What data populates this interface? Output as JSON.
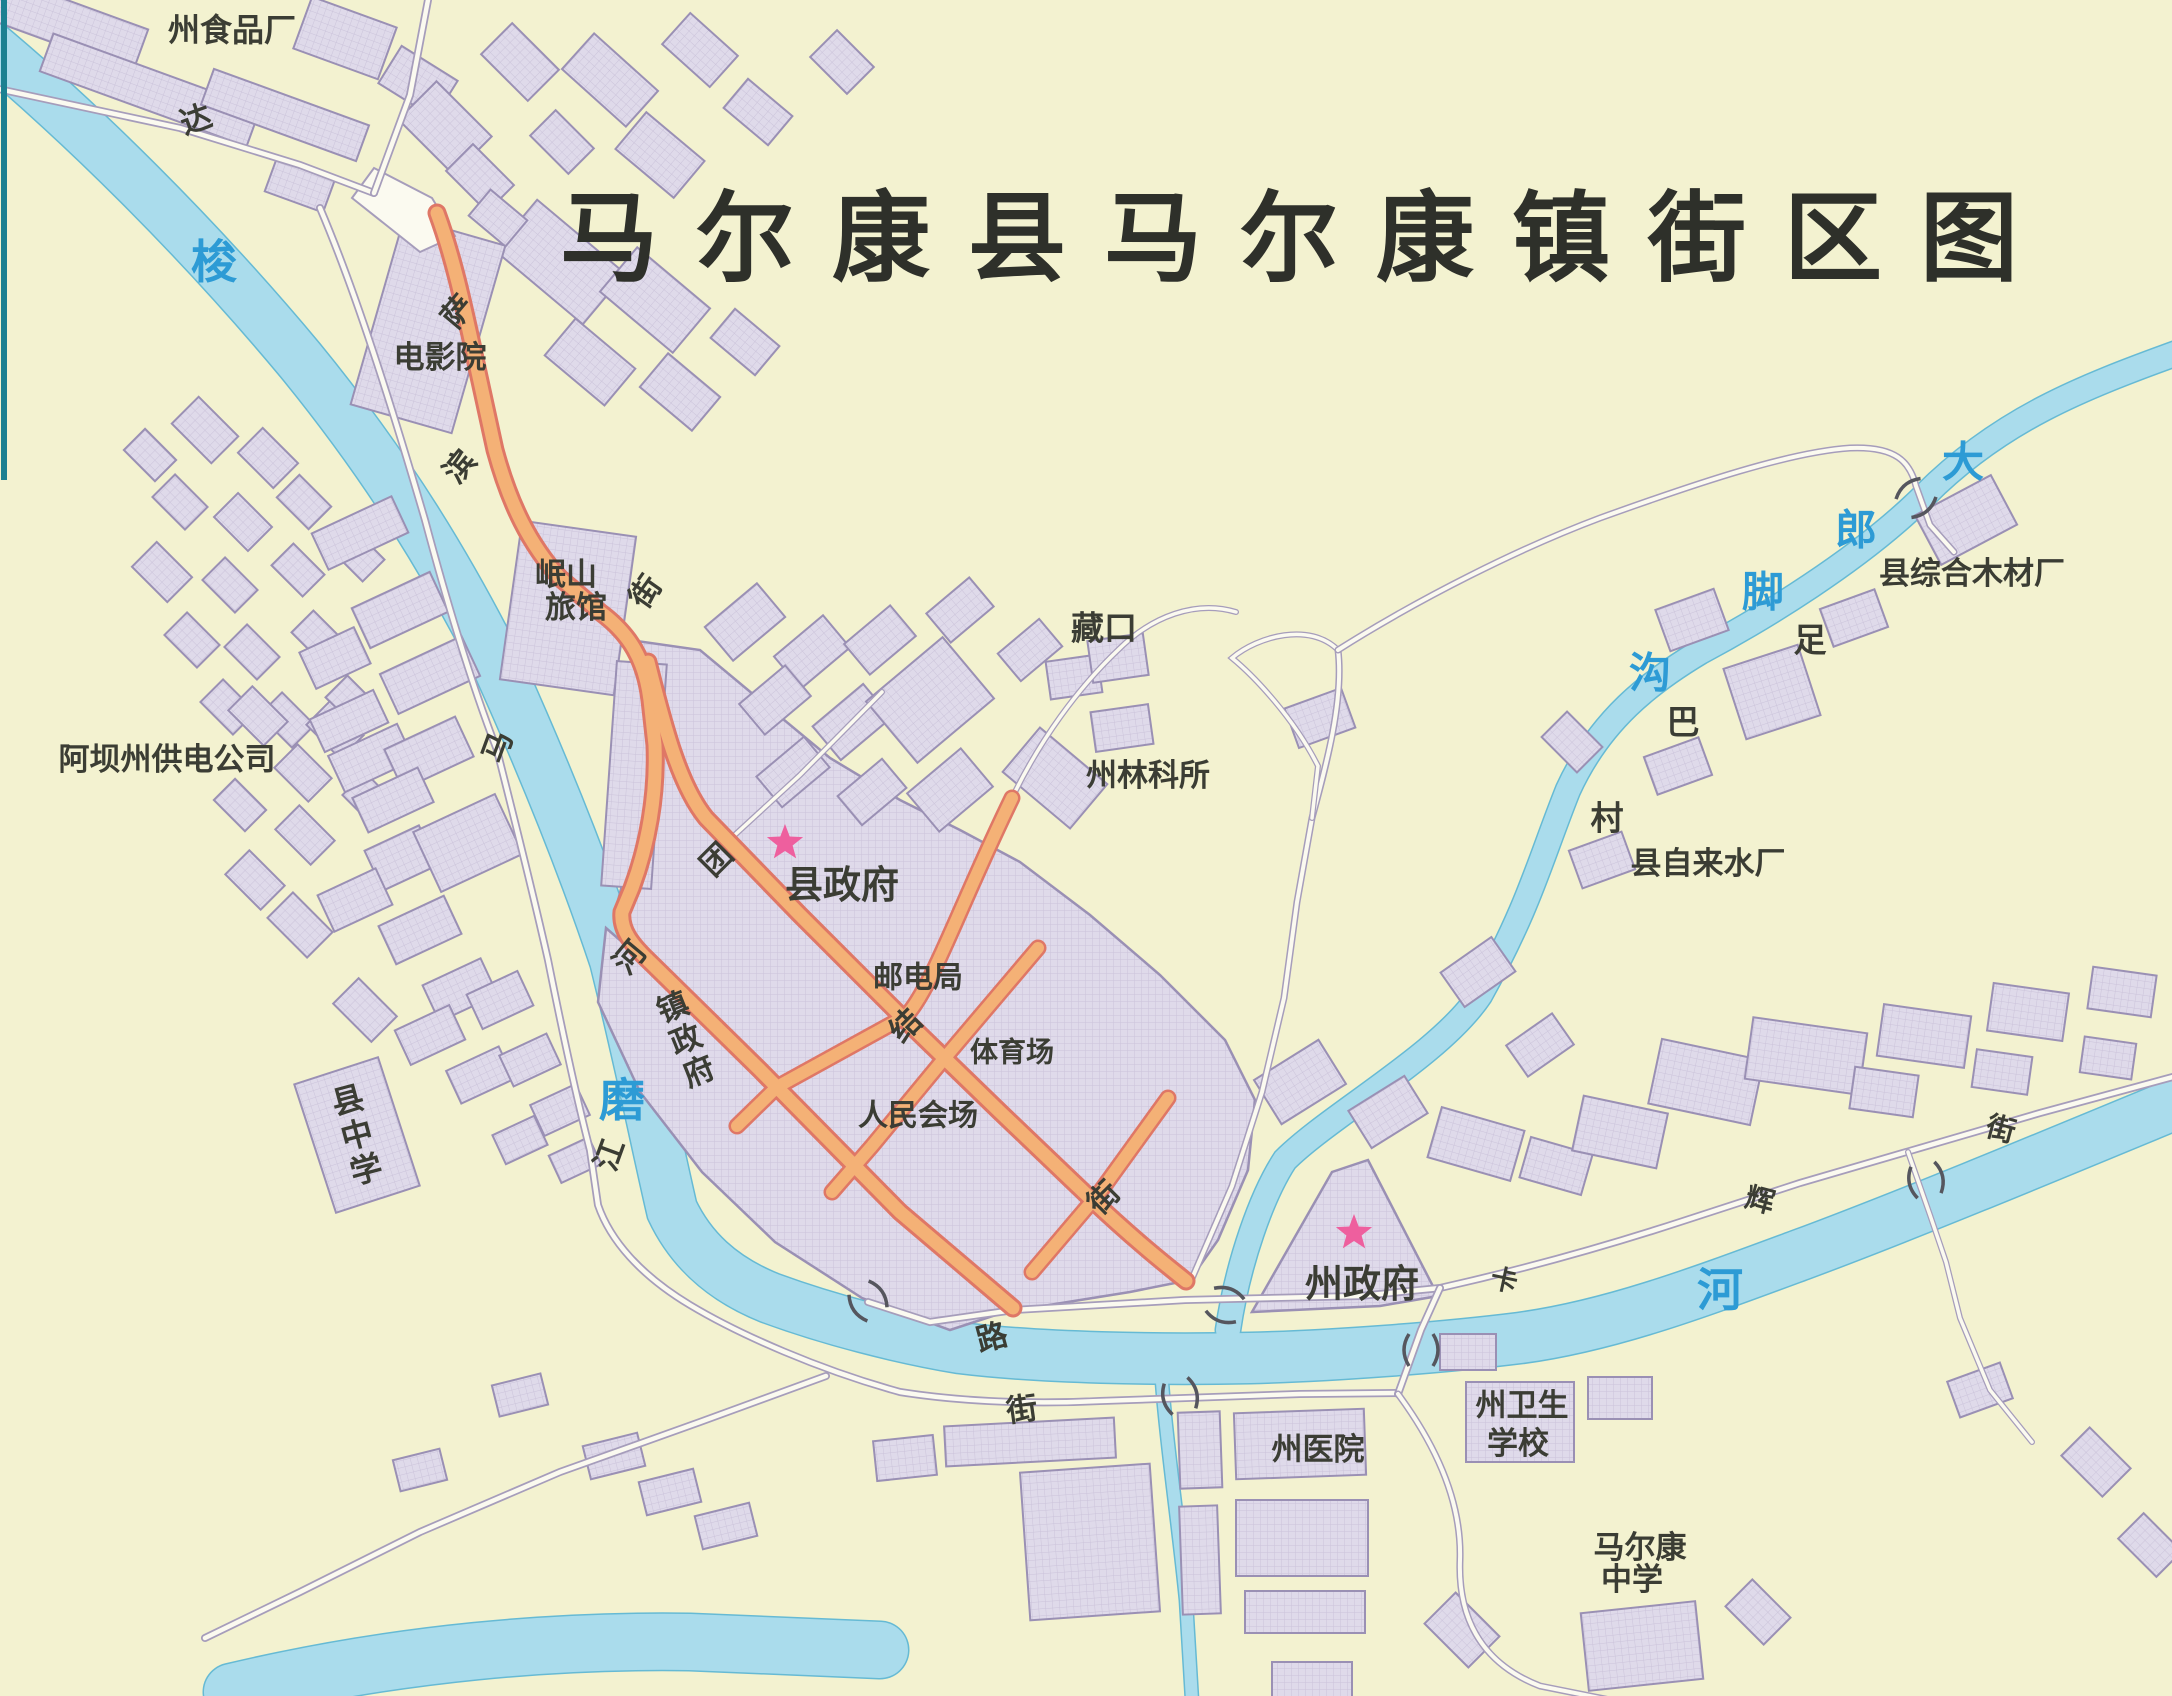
{
  "title": "马尔康县马尔康镇街区图",
  "map": {
    "colors": {
      "paper": "#f3f2d0",
      "water": "#aadcec",
      "water_edge": "#66bad4",
      "building": "#dfdaea",
      "building_edge": "#9a90b4",
      "road_orange": "#f4b176",
      "road_orange_edge": "#df7766",
      "road_white": "#fbfaf0",
      "road_edge": "#a69dbb",
      "label": "#3b3d34",
      "river_label": "#2d9bd5",
      "star": "#ee5f9e",
      "neatline": "#1b8091"
    },
    "stars": [
      {
        "name": "county-government-star",
        "x": 785,
        "y": 843
      },
      {
        "name": "prefecture-government-star",
        "x": 1354,
        "y": 1233
      }
    ],
    "bridges": [
      {
        "x": 1225,
        "y": 1305,
        "r": 20
      },
      {
        "x": 1421,
        "y": 1350,
        "r": 90
      },
      {
        "x": 1180,
        "y": 1396,
        "r": 75
      },
      {
        "x": 868,
        "y": 1301,
        "r": 55
      },
      {
        "x": 1926,
        "y": 1180,
        "r": 78
      },
      {
        "x": 1916,
        "y": 498,
        "r": -40
      }
    ],
    "labels": [
      {
        "t": "州食品厂",
        "x": 232,
        "y": 30,
        "s": 32,
        "c": "place"
      },
      {
        "t": "电影院",
        "x": 440,
        "y": 358,
        "s": 31,
        "c": "place"
      },
      {
        "t": "岷山",
        "x": 566,
        "y": 575,
        "s": 31,
        "c": "place"
      },
      {
        "t": "旅馆",
        "x": 576,
        "y": 608,
        "s": 31,
        "c": "place"
      },
      {
        "t": "阿坝州供电公司",
        "x": 167,
        "y": 760,
        "s": 31,
        "c": "place"
      },
      {
        "t": "县中学",
        "x": 357,
        "y": 1135,
        "s": 32,
        "c": "place",
        "v": 1,
        "r": -15
      },
      {
        "t": "县政府",
        "x": 842,
        "y": 885,
        "s": 38,
        "c": "place"
      },
      {
        "t": "邮电局",
        "x": 918,
        "y": 978,
        "s": 30,
        "c": "place"
      },
      {
        "t": "体育场",
        "x": 1012,
        "y": 1052,
        "s": 28,
        "c": "place"
      },
      {
        "t": "人民会场",
        "x": 918,
        "y": 1116,
        "s": 30,
        "c": "place"
      },
      {
        "t": "镇政府",
        "x": 686,
        "y": 1040,
        "s": 31,
        "c": "place",
        "v": 1,
        "r": -22
      },
      {
        "t": "藏口",
        "x": 1104,
        "y": 628,
        "s": 33,
        "c": "place"
      },
      {
        "t": "州林科所",
        "x": 1148,
        "y": 776,
        "s": 31,
        "c": "place"
      },
      {
        "t": "州政府",
        "x": 1362,
        "y": 1284,
        "s": 38,
        "c": "place"
      },
      {
        "t": "州医院",
        "x": 1318,
        "y": 1450,
        "s": 31,
        "c": "place"
      },
      {
        "t": "州卫生",
        "x": 1522,
        "y": 1406,
        "s": 31,
        "c": "place"
      },
      {
        "t": "学校",
        "x": 1518,
        "y": 1444,
        "s": 31,
        "c": "place"
      },
      {
        "t": "马尔康",
        "x": 1640,
        "y": 1548,
        "s": 31,
        "c": "place"
      },
      {
        "t": "中学",
        "x": 1632,
        "y": 1580,
        "s": 31,
        "c": "place"
      },
      {
        "t": "县综合木材厂",
        "x": 1972,
        "y": 574,
        "s": 31,
        "c": "place"
      },
      {
        "t": "县自来水厂",
        "x": 1708,
        "y": 864,
        "s": 31,
        "c": "place"
      },
      {
        "t": "足",
        "x": 1810,
        "y": 640,
        "s": 33,
        "c": "place"
      },
      {
        "t": "巴",
        "x": 1683,
        "y": 722,
        "s": 33,
        "c": "place"
      },
      {
        "t": "村",
        "x": 1607,
        "y": 818,
        "s": 33,
        "c": "place"
      },
      {
        "t": "达",
        "x": 196,
        "y": 120,
        "s": 31,
        "c": "street",
        "r": -20
      },
      {
        "t": "萨",
        "x": 458,
        "y": 312,
        "s": 31,
        "c": "street",
        "r": -50
      },
      {
        "t": "滨",
        "x": 460,
        "y": 467,
        "s": 31,
        "c": "street",
        "r": -50
      },
      {
        "t": "街",
        "x": 646,
        "y": 592,
        "s": 31,
        "c": "street",
        "r": -55
      },
      {
        "t": "马",
        "x": 498,
        "y": 747,
        "s": 31,
        "c": "street",
        "r": -70
      },
      {
        "t": "河",
        "x": 630,
        "y": 958,
        "s": 31,
        "c": "street",
        "r": -50
      },
      {
        "t": "江",
        "x": 610,
        "y": 1155,
        "s": 31,
        "c": "street",
        "r": -70
      },
      {
        "t": "团",
        "x": 717,
        "y": 860,
        "s": 31,
        "c": "street",
        "r": -45
      },
      {
        "t": "结",
        "x": 906,
        "y": 1026,
        "s": 31,
        "c": "street",
        "r": -45
      },
      {
        "t": "街",
        "x": 1104,
        "y": 1198,
        "s": 31,
        "c": "street",
        "r": -45
      },
      {
        "t": "路",
        "x": 992,
        "y": 1338,
        "s": 31,
        "c": "street",
        "r": -15
      },
      {
        "t": "街",
        "x": 1022,
        "y": 1410,
        "s": 31,
        "c": "street",
        "r": -8
      },
      {
        "t": "卡",
        "x": 1504,
        "y": 1281,
        "s": 27,
        "c": "street",
        "r": 12
      },
      {
        "t": "辉",
        "x": 1760,
        "y": 1200,
        "s": 29,
        "c": "street",
        "r": 15
      },
      {
        "t": "街",
        "x": 2001,
        "y": 1129,
        "s": 29,
        "c": "street",
        "r": 15
      },
      {
        "t": "梭",
        "x": 214,
        "y": 262,
        "s": 46,
        "c": "river"
      },
      {
        "t": "磨",
        "x": 622,
        "y": 1100,
        "s": 46,
        "c": "river"
      },
      {
        "t": "河",
        "x": 1720,
        "y": 1290,
        "s": 46,
        "c": "river"
      },
      {
        "t": "大",
        "x": 1963,
        "y": 462,
        "s": 42,
        "c": "river"
      },
      {
        "t": "郎",
        "x": 1856,
        "y": 530,
        "s": 42,
        "c": "river"
      },
      {
        "t": "脚",
        "x": 1763,
        "y": 592,
        "s": 42,
        "c": "river"
      },
      {
        "t": "沟",
        "x": 1650,
        "y": 673,
        "s": 42,
        "c": "river"
      }
    ]
  }
}
